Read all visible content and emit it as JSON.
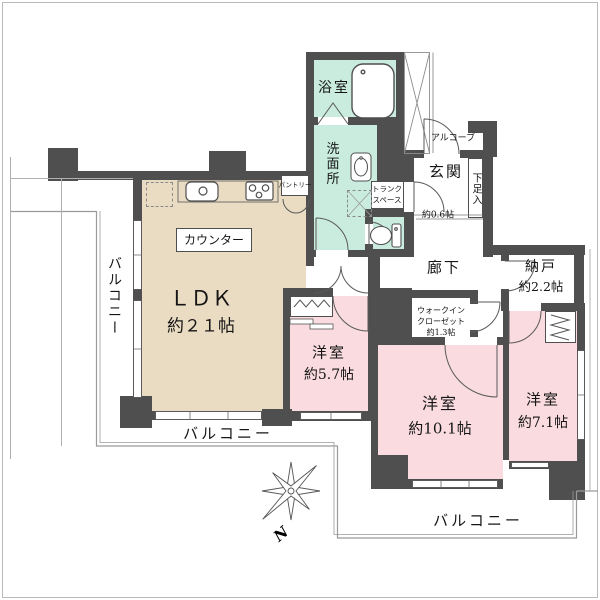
{
  "colors": {
    "wall": "#4f4f4f",
    "ldk_fill": "#eadcc2",
    "bedroom_fill": "#f9dbe0",
    "wet_area_fill": "#c9ecdf",
    "outline": "#9a9a9a"
  },
  "rooms": {
    "ldk": {
      "name": "ＬＤＫ",
      "size": "約２１帖"
    },
    "counter": "カウンター",
    "pantry": "パントリー",
    "bath": "浴室",
    "washroom": "洗面所",
    "trunk": {
      "line1": "トランク",
      "line2": "スペース",
      "size": "約0.6帖"
    },
    "genkan": "玄関",
    "shoe_box": "下足入",
    "alcove": "アルコーブ",
    "corridor": "廊下",
    "storage": {
      "name": "納戸",
      "size": "約2.2帖"
    },
    "wic": {
      "line1": "ウォークイン",
      "line2": "クローゼット",
      "line3": "約1.3帖"
    },
    "bedroom1": {
      "name": "洋室",
      "size": "約5.7帖"
    },
    "bedroom2": {
      "name": "洋室",
      "size": "約10.1帖"
    },
    "bedroom3": {
      "name": "洋室",
      "size": "約7.1帖"
    }
  },
  "balconies": {
    "left": "バルコニー",
    "bottom_left": "バルコニー",
    "bottom_right": "バルコニー"
  },
  "compass": {
    "north": "N"
  }
}
